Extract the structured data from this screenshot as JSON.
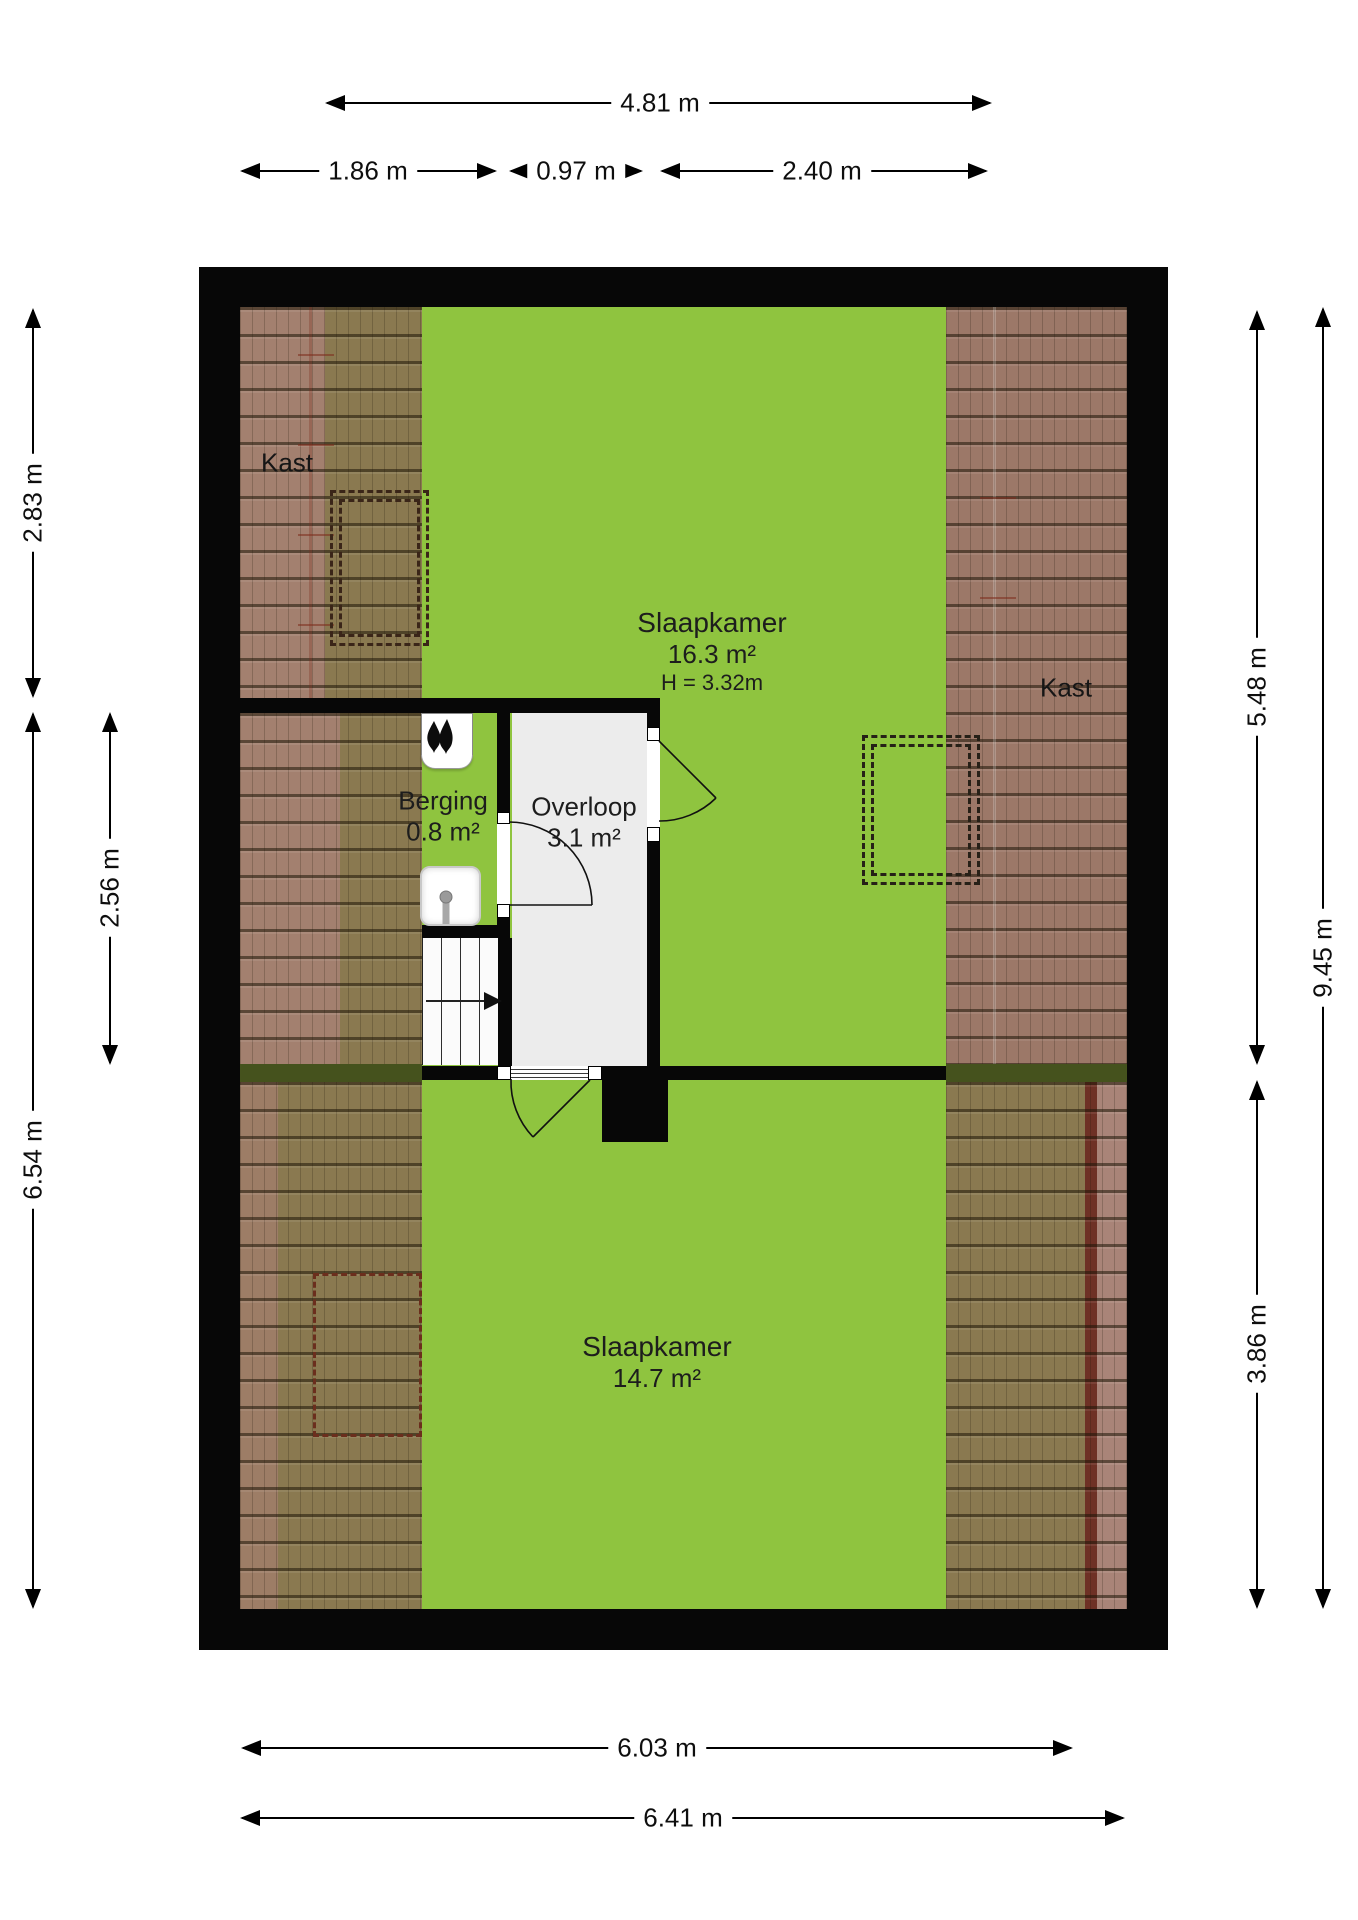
{
  "document": {
    "type": "floor-plan",
    "language": "nl"
  },
  "rooms": {
    "slaapkamer_boven": {
      "name": "Slaapkamer",
      "area": "16.3 m²",
      "ceiling_height": "H = 3.32m"
    },
    "slaapkamer_onder": {
      "name": "Slaapkamer",
      "area": "14.7 m²"
    },
    "berging": {
      "name": "Berging",
      "area": "0.8 m²"
    },
    "overloop": {
      "name": "Overloop",
      "area": "3.1 m²"
    },
    "kast_links": {
      "name": "Kast"
    },
    "kast_rechts": {
      "name": "Kast"
    }
  },
  "dimensions": {
    "top_total": "4.81 m",
    "top_segments": [
      "1.86 m",
      "0.97 m",
      "2.40 m"
    ],
    "left_outer_upper": "2.83 m",
    "left_inner": "2.56 m",
    "left_outer_lower": "6.54 m",
    "right_inner_upper": "5.48 m",
    "right_outer": "9.45 m",
    "right_inner_lower": "3.86 m",
    "bottom_inner": "6.03 m",
    "bottom_outer": "6.41 m"
  },
  "fixtures": {
    "stairs": "stairs-with-direction-arrow",
    "mv_unit": "mechanical-ventilation-unit",
    "sink": "wash-basin",
    "chimney": "chimney-duct-block"
  },
  "colors": {
    "floor_green": "#8FC43F",
    "floor_gray": "#ECECEC",
    "wall_black": "#070707",
    "tile_pink": "#A3806F",
    "tile_olive": "#8A7950",
    "tile_pink_right": "#9C7868",
    "tile_pink_lower_right": "#A98478",
    "ridge_red": "#6E3125",
    "background": "#FFFFFF"
  }
}
